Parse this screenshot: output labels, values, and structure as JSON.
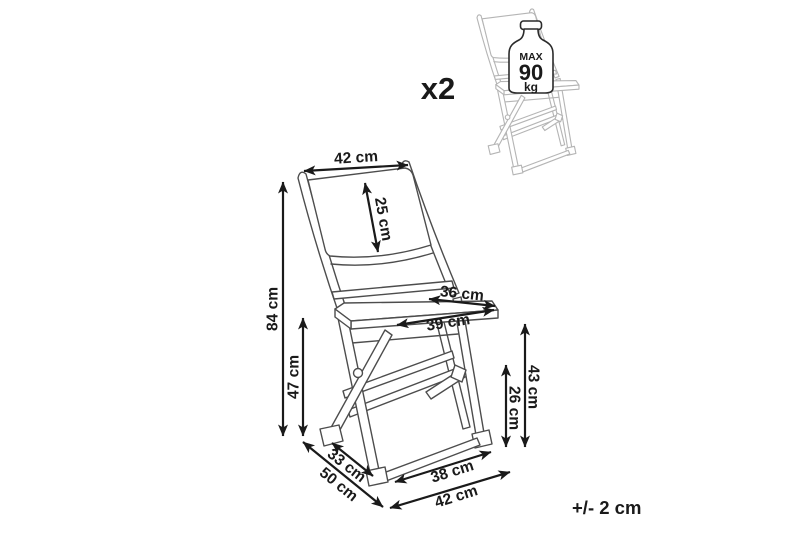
{
  "diagram": {
    "quantity_label": "x2",
    "tolerance_label": "+/- 2 cm",
    "max_load": {
      "prefix": "MAX",
      "value": "90",
      "unit": "kg"
    },
    "colors": {
      "chair_line": "#4d4d4d",
      "ghost_chair_line": "#b5b5b5",
      "dimension_ink": "#1a1a1a",
      "background": "#ffffff"
    }
  },
  "dimensions": [
    {
      "id": "backrest-width",
      "label": "42 cm"
    },
    {
      "id": "backrest-height",
      "label": "25 cm"
    },
    {
      "id": "overall-height",
      "label": "84 cm"
    },
    {
      "id": "seat-height",
      "label": "47 cm"
    },
    {
      "id": "seat-depth",
      "label": "36 cm"
    },
    {
      "id": "seat-width",
      "label": "39 cm"
    },
    {
      "id": "rear-frame-height",
      "label": "43 cm"
    },
    {
      "id": "stretcher-height",
      "label": "26 cm"
    },
    {
      "id": "base-side-inner",
      "label": "33 cm"
    },
    {
      "id": "base-side-outer",
      "label": "50 cm"
    },
    {
      "id": "base-front-inner",
      "label": "38 cm"
    },
    {
      "id": "base-front-outer",
      "label": "42 cm"
    }
  ]
}
